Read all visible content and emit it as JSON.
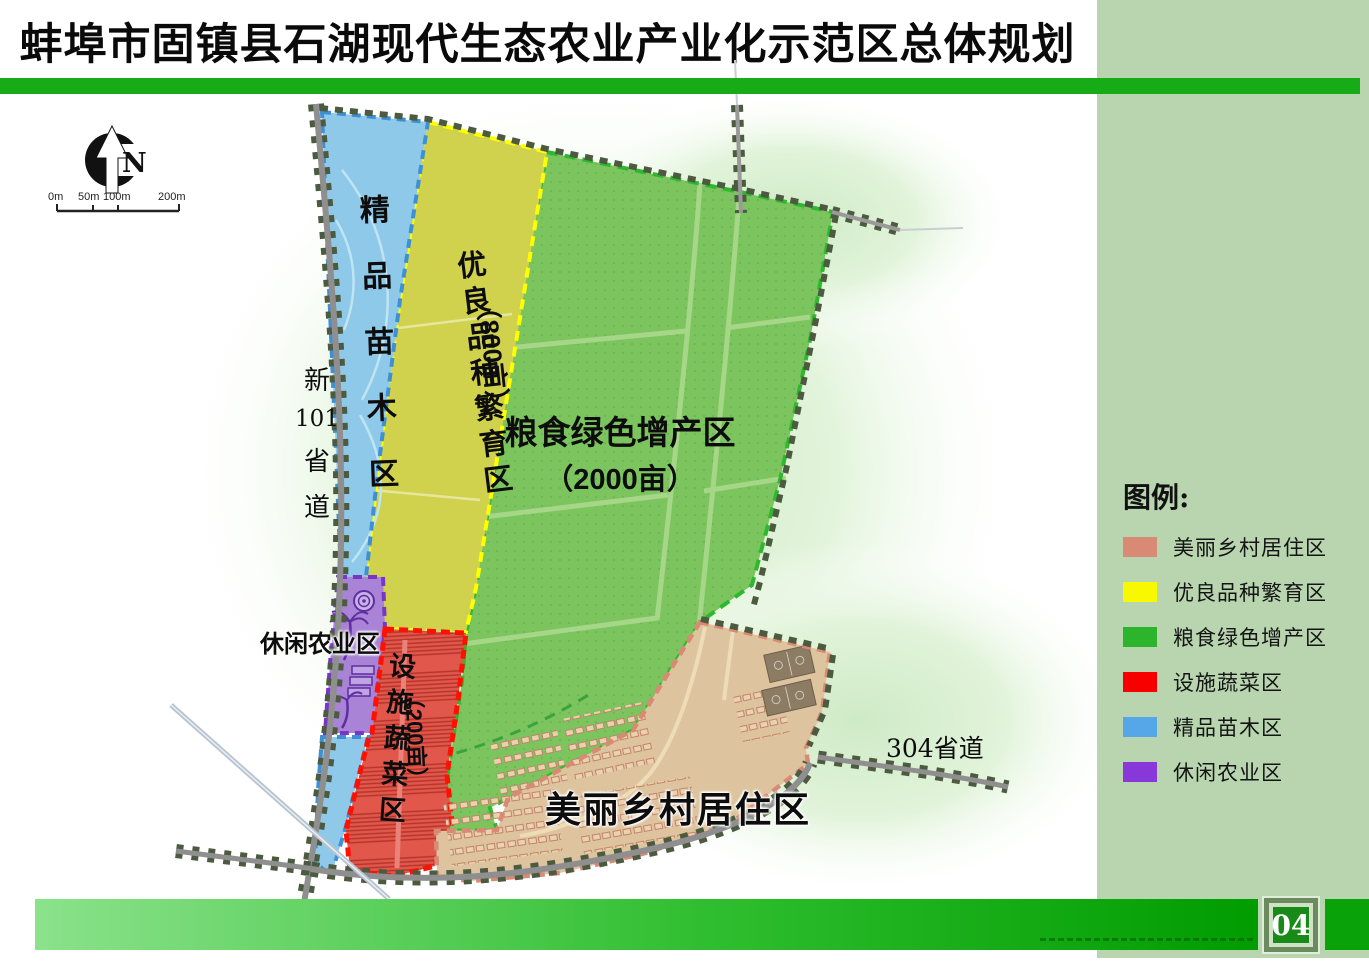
{
  "header": {
    "title": "蚌埠市固镇县石湖现代生态农业产业化示范区总体规划",
    "panel_title": "功能分区图"
  },
  "compass": {
    "north_label": "N"
  },
  "scale_bar": {
    "ticks": [
      "0m",
      "50m",
      "100m",
      "200m"
    ]
  },
  "map": {
    "zones": {
      "nursery": {
        "label": "精品苗木区",
        "color": "#8ec9e9",
        "border_color": "#3f8fd6"
      },
      "breeding": {
        "label": "优良品种繁育区",
        "area": "（800亩）",
        "color": "#d0d14c",
        "border_color": "#ffff00"
      },
      "grain": {
        "label": "粮食绿色增产区",
        "area": "（2000亩）",
        "color": "#7cc45e",
        "border_color": "#2eb82e"
      },
      "vegetable": {
        "label": "设施蔬菜区",
        "area": "（200亩）",
        "color": "#e2574b",
        "border_color": "#ff1000"
      },
      "leisure": {
        "label": "休闲农业区",
        "color": "#a883d6",
        "border_color": "#7a35c8"
      },
      "village": {
        "label": "美丽乡村居住区",
        "color": "#dec49e",
        "border_color": "#d98a74"
      }
    },
    "roads": {
      "road101": {
        "label": "新101省道",
        "parts": [
          "新",
          "101",
          "省",
          "道"
        ]
      },
      "road304": {
        "label": "304省道"
      }
    }
  },
  "legend": {
    "title": "图例:",
    "items": [
      {
        "label": "美丽乡村居住区",
        "color": "#d98a74"
      },
      {
        "label": "优良品种繁育区",
        "color": "#f8f800"
      },
      {
        "label": "粮食绿色增产区",
        "color": "#2cb42c"
      },
      {
        "label": "设施蔬菜区",
        "color": "#f80000"
      },
      {
        "label": "精品苗木区",
        "color": "#55a7e8"
      },
      {
        "label": "休闲农业区",
        "color": "#8838d8"
      }
    ]
  },
  "footer": {
    "page_number": "04"
  }
}
